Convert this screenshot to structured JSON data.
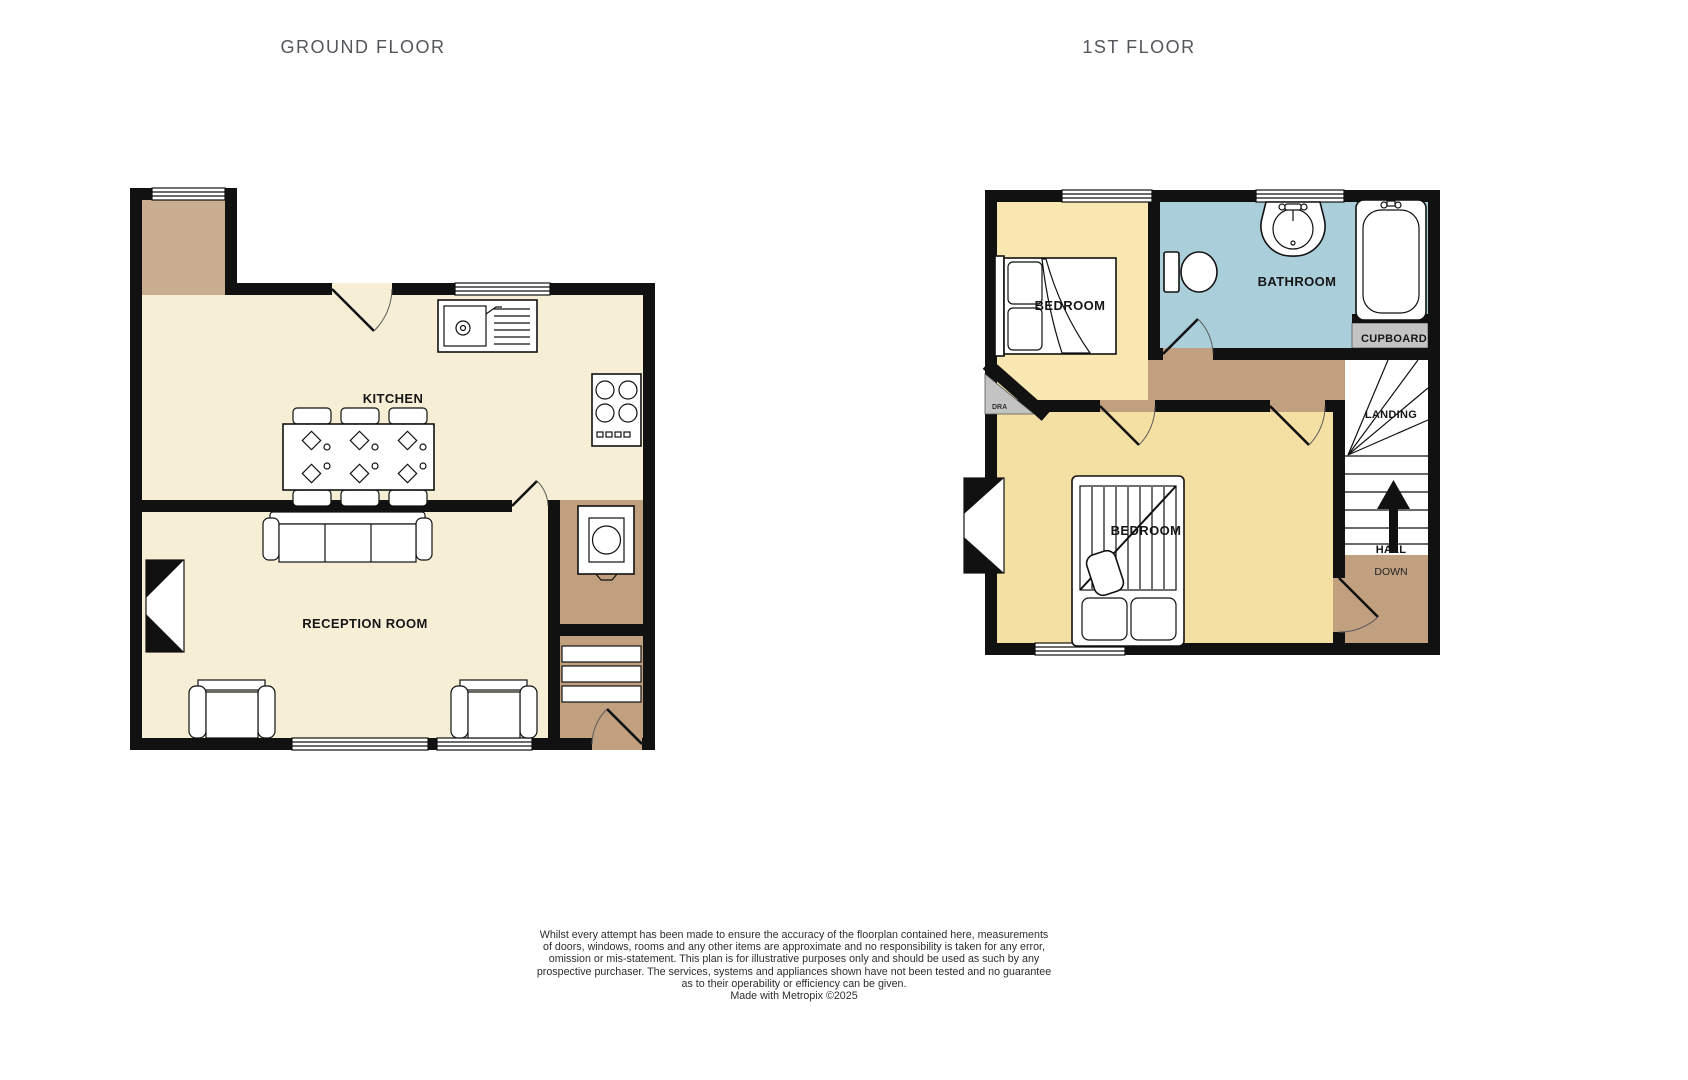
{
  "titles": {
    "ground": "GROUND FLOOR",
    "first": "1ST FLOOR"
  },
  "ground_floor": {
    "kitchen_label": "KITCHEN",
    "reception_label": "RECEPTION ROOM",
    "fixtures": [
      "sink-drainer-icon",
      "hob-icon",
      "dining-table-icon",
      "sofa-icon",
      "armchair-icon",
      "washing-machine-icon",
      "staircase-icon",
      "bay-window-icon",
      "door-arc-icon",
      "window-icon"
    ]
  },
  "first_floor": {
    "bedroom_front_label": "BEDROOM",
    "bathroom_label": "BATHROOM",
    "cupboard_label": "CUPBOARD",
    "landing_label": "LANDING",
    "bedroom_back_label": "BEDROOM",
    "hall_label": "HALL",
    "down_label": "DOWN",
    "wardrobe_label": "DRA",
    "fixtures": [
      "single-bed-icon",
      "toilet-icon",
      "basin-icon",
      "bathtub-icon",
      "double-bed-icon",
      "staircase-icon",
      "up-arrow-icon",
      "bay-window-icon",
      "door-arc-icon",
      "window-icon"
    ]
  },
  "colors": {
    "wall": "#111111",
    "ground_room": "#f6efd6",
    "hall_tan_light": "#c9ad8e",
    "hall_tan": "#c1a080",
    "bedroom_front": "#f8e7b0",
    "bedroom_back": "#f5e0a4",
    "bathroom": "#abcfda",
    "cupboard_gray": "#c3c3c3"
  },
  "disclaimer": {
    "lines": [
      "Whilst every attempt has been made to ensure the accuracy of the floorplan contained here, measurements",
      "of doors, windows, rooms and any other items are approximate and no responsibility is taken for any error,",
      "omission or mis-statement. This plan is for illustrative purposes only and should be used as such by any",
      "prospective purchaser. The services, systems and appliances shown have not been tested and no guarantee",
      "as to their operability or efficiency can be given.",
      "Made with Metropix ©2025"
    ]
  }
}
